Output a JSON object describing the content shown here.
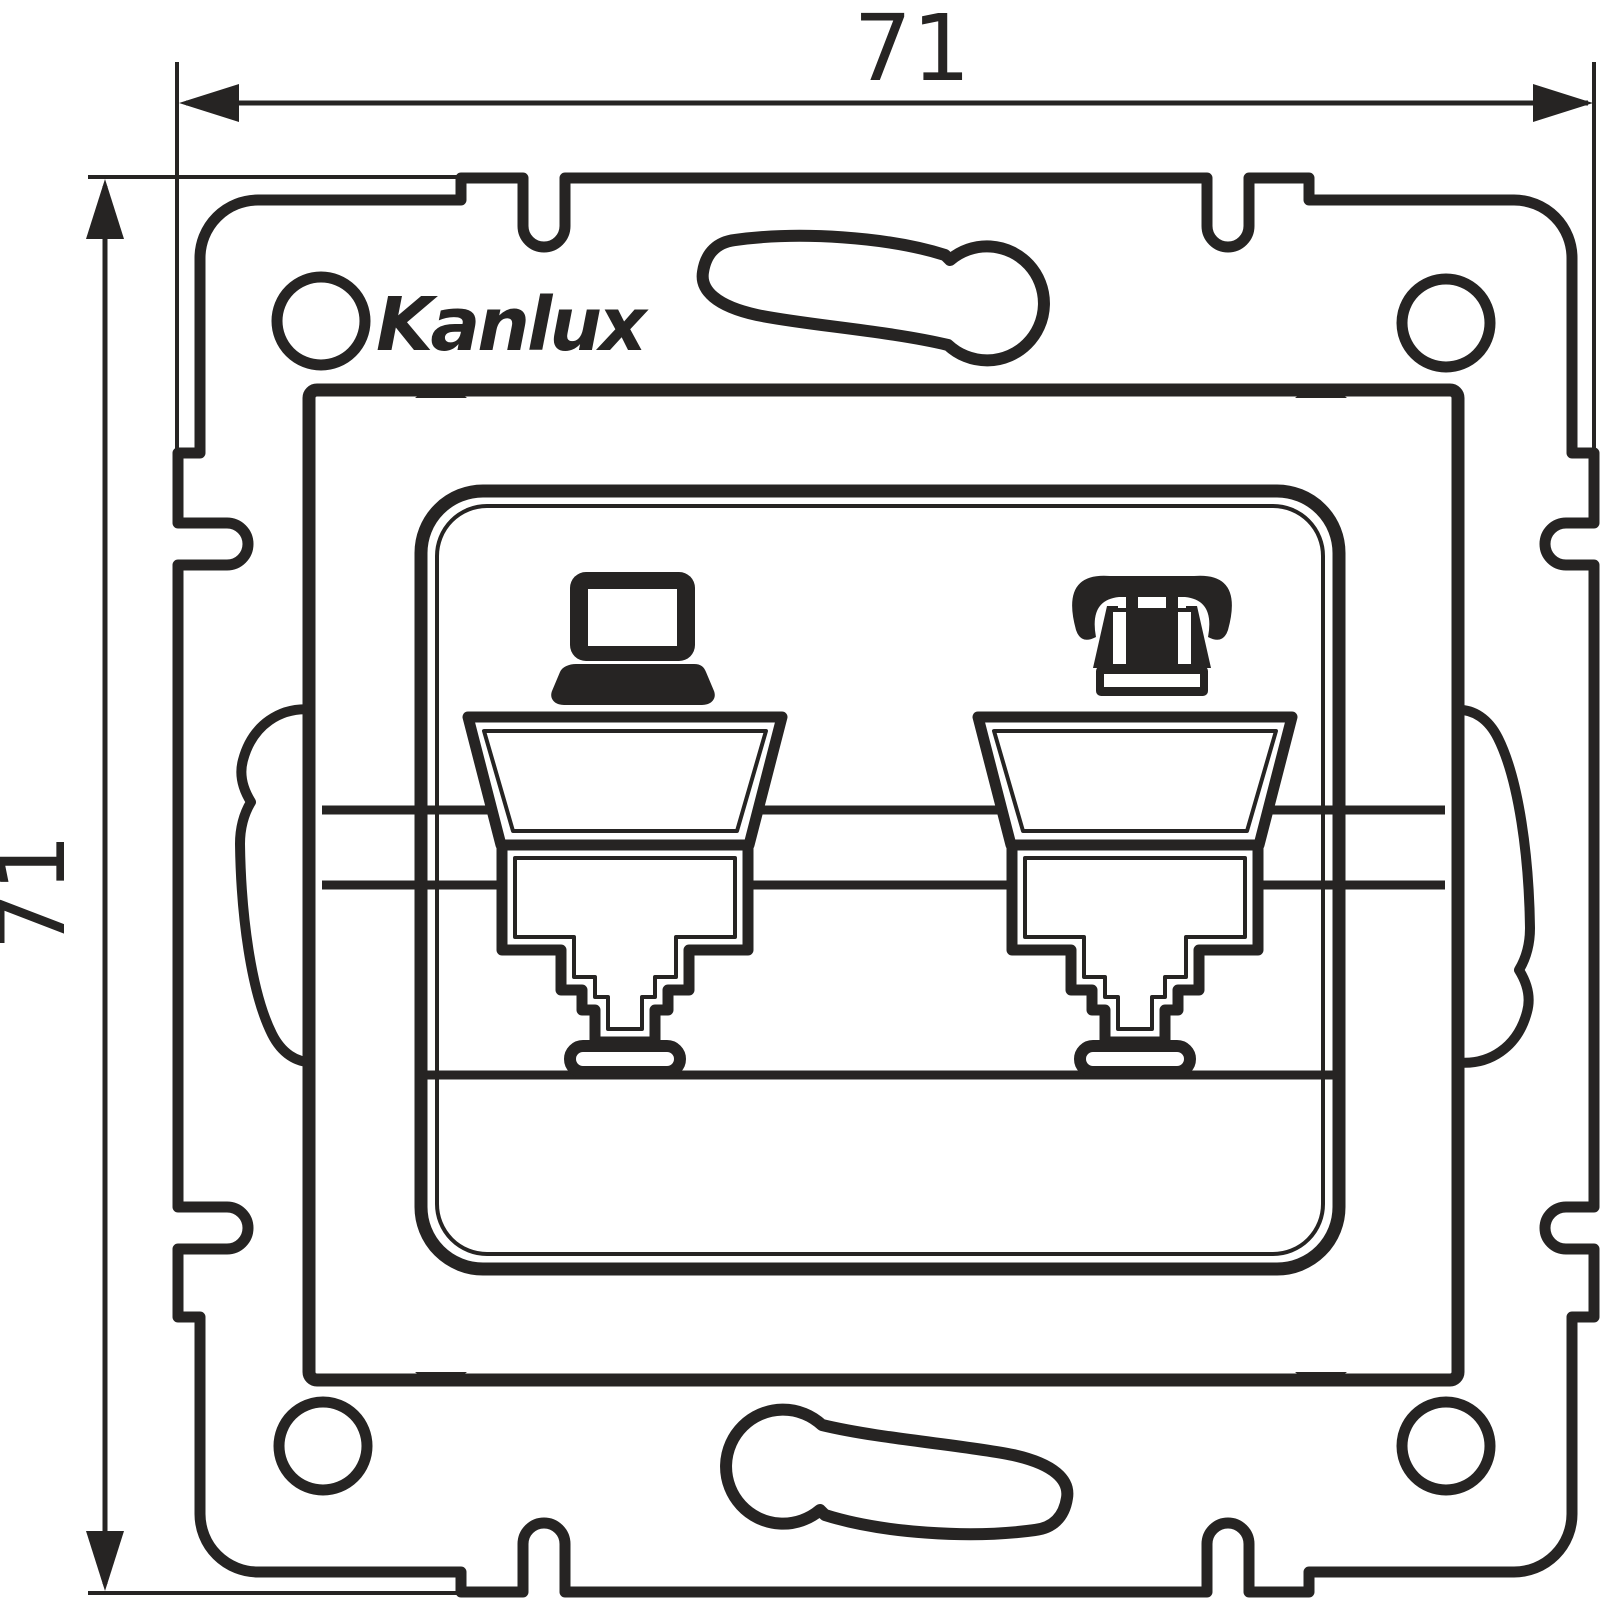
{
  "drawing": {
    "title": "Kanlux wall insert technical drawing",
    "logo_text": "Kanlux",
    "dimension_width_label": "71",
    "dimension_height_label": "71"
  },
  "icons": {
    "left_port": "computer-laptop-icon",
    "right_port": "telephone-icon"
  },
  "colors": {
    "line": "#262423",
    "background": "#ffffff"
  }
}
